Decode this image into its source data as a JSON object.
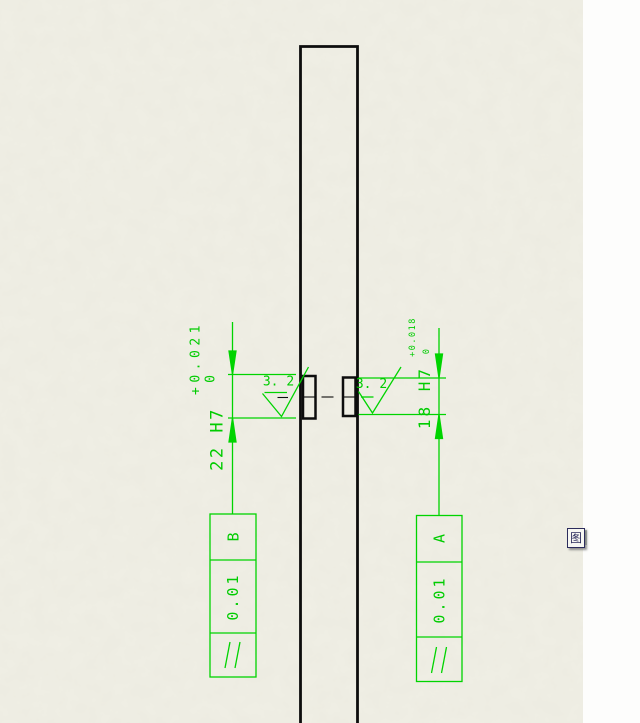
{
  "app": {
    "sheet_background": "#f0efe5",
    "panel_background": "#fdfdfc",
    "annotation_green": "#00cc00",
    "part_line_color": "#0d0d0d"
  },
  "drawing": {
    "dimensions": [
      {
        "id": "left-bore",
        "value": "22 H7",
        "upper_tol": "+0.021",
        "lower_tol": "0"
      },
      {
        "id": "right-bore",
        "value": "18 H7",
        "upper_tol": "+0.018",
        "lower_tol": "0"
      }
    ],
    "surface_finish": [
      {
        "value": "3. 2"
      },
      {
        "value": "3. 2"
      }
    ],
    "feature_control_frames": [
      {
        "symbol": "parallelism",
        "tolerance": "0.01",
        "datum": "B"
      },
      {
        "symbol": "parallelism",
        "tolerance": "0.01",
        "datum": "A"
      }
    ]
  },
  "overlay": {
    "icon_label": "图"
  }
}
